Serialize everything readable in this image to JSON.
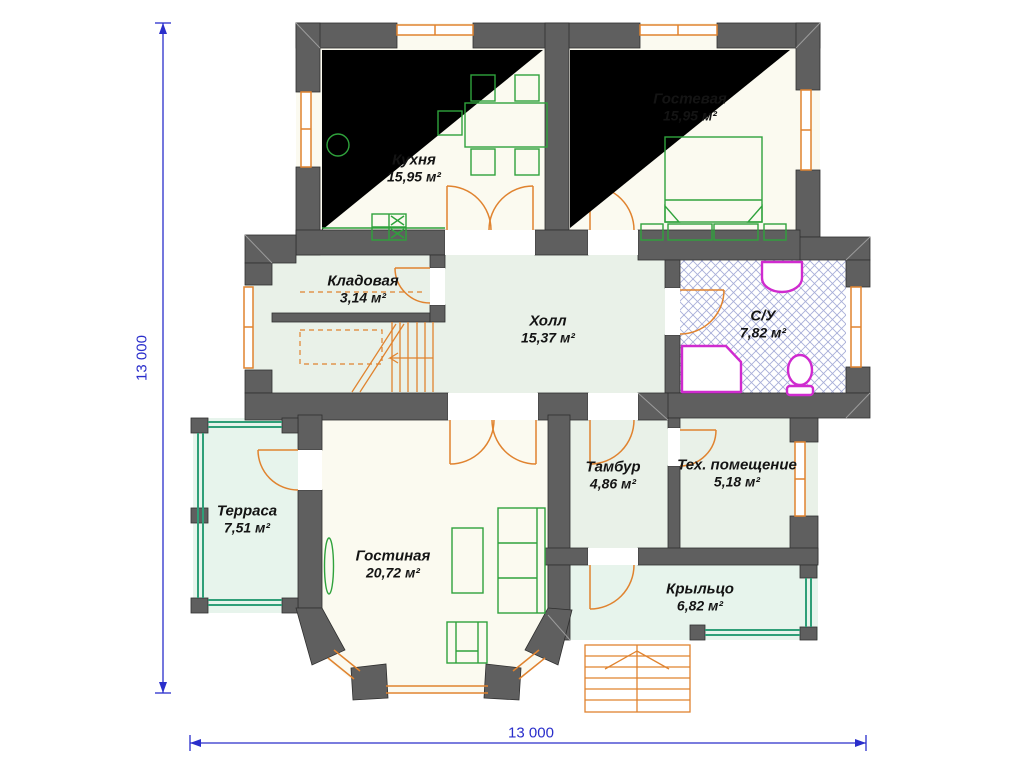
{
  "rooms": [
    {
      "name": "Кухня",
      "area": "15,95 м²"
    },
    {
      "name": "Гостевая",
      "area": "15,95 м²"
    },
    {
      "name": "Кладовая",
      "area": "3,14 м²"
    },
    {
      "name": "Холл",
      "area": "15,37 м²"
    },
    {
      "name": "С/У",
      "area": "7,82 м²"
    },
    {
      "name": "Терраса",
      "area": "7,51 м²"
    },
    {
      "name": "Гостиная",
      "area": "20,72 м²"
    },
    {
      "name": "Тамбур",
      "area": "4,86 м²"
    },
    {
      "name": "Тех. помещение",
      "area": "5,18 м²"
    },
    {
      "name": "Крыльцо",
      "area": "6,82 м²"
    }
  ],
  "dimensions": {
    "left": "13 000",
    "bottom": "13 000"
  },
  "colors": {
    "wall-color": "#5f5f5f",
    "wall-edge": "#2f2f2f",
    "wall-light": "#9c9c9c",
    "opening-color": "#e0832f",
    "furniture-color": "#2fa23c",
    "railing-color": "#2f9f78",
    "plumbing-color": "#cf2bcf",
    "hatch-color": "#a8aed8",
    "dimension-color": "#2a2ecb",
    "floor-cream": "#fbfaf0",
    "floor-pale": "#e9f1e8",
    "floor-mint": "#e7f4ec",
    "label-color": "#141414"
  }
}
